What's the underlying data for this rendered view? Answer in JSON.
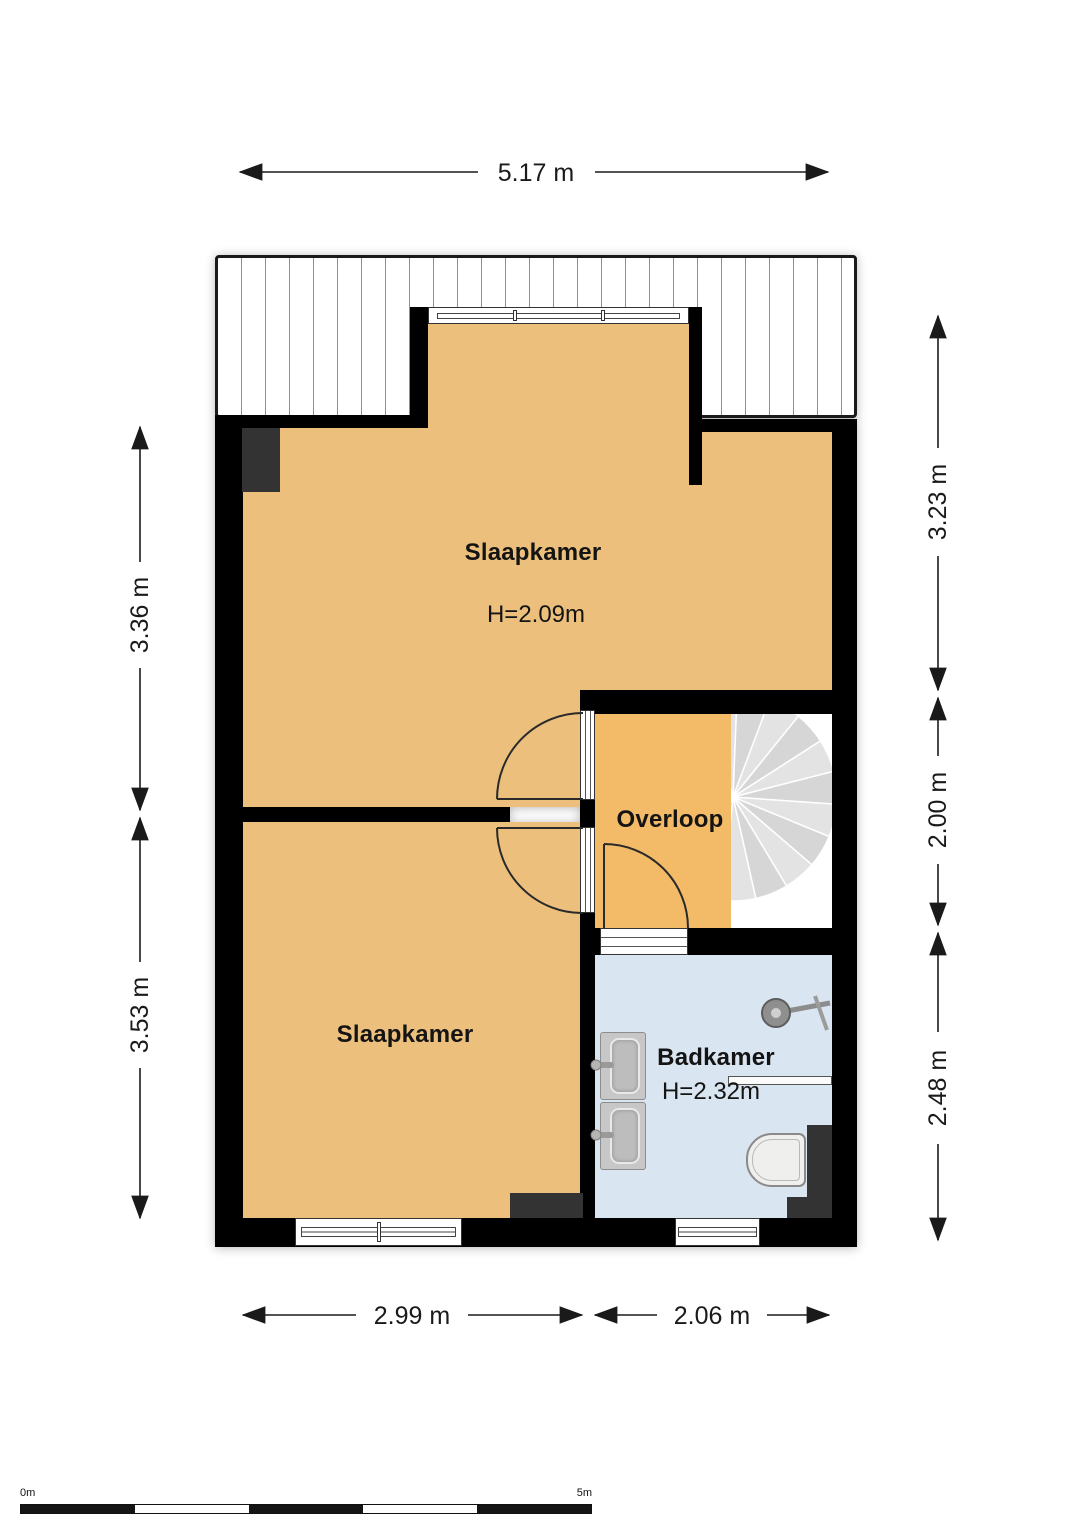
{
  "rooms": {
    "bedroom_top": {
      "name": "Slaapkamer",
      "ceiling_height": "H=2.09m"
    },
    "bedroom_bottom": {
      "name": "Slaapkamer"
    },
    "landing": {
      "name": "Overloop"
    },
    "bathroom": {
      "name": "Badkamer",
      "ceiling_height": "H=2.32m"
    }
  },
  "dimensions": {
    "top_width": "5.17 m",
    "left_upper": "3.36 m",
    "left_lower": "3.53 m",
    "right_upper": "3.23 m",
    "right_middle": "2.00 m",
    "right_lower": "2.48 m",
    "bottom_left": "2.99 m",
    "bottom_right": "2.06 m"
  },
  "scale_bar": {
    "start_label": "0m",
    "end_label": "5m"
  },
  "fixtures": [
    "spiral-staircase",
    "toilet",
    "sink",
    "sink",
    "shower",
    "duct",
    "duct",
    "duct"
  ],
  "colors": {
    "wall": "#000000",
    "bedroom_floor": "#ecc07c",
    "landing_floor": "#f3ba68",
    "bathroom_floor": "#d9e5f1",
    "duct": "#333333",
    "stair_tread_light": "#e3e3e3",
    "stair_tread_dark": "#d6d6d6",
    "dimension_line": "#1a1a1a"
  }
}
